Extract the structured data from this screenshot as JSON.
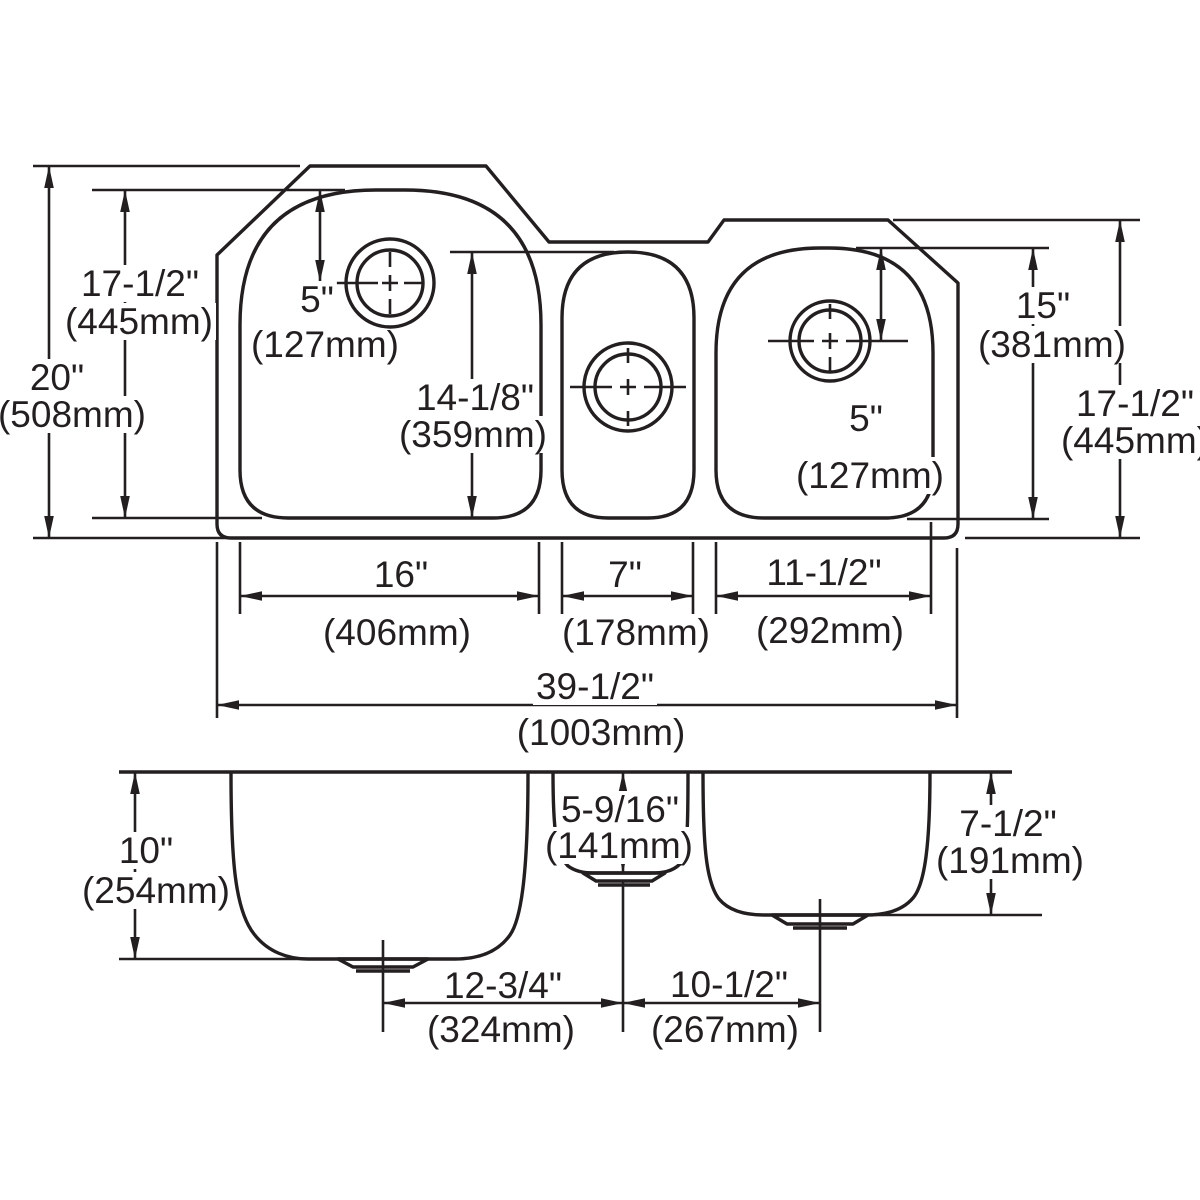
{
  "colors": {
    "line": "#231f20",
    "background": "#ffffff"
  },
  "top_view": {
    "overall_height_in": "20\"",
    "overall_height_mm": "(508mm)",
    "left_bowl_height_in": "17-1/2\"",
    "left_bowl_height_mm": "(445mm)",
    "left_faucet_offset_in": "5\"",
    "left_faucet_offset_mm": "(127mm)",
    "middle_bowl_length_in": "14-1/8\"",
    "middle_bowl_length_mm": "(359mm)",
    "right_bowl_length_in": "15\"",
    "right_bowl_length_mm": "(381mm)",
    "right_rim_height_in": "17-1/2\"",
    "right_rim_height_mm": "(445mm)",
    "right_faucet_offset_in": "5\"",
    "right_faucet_offset_mm": "(127mm)",
    "left_bowl_width_in": "16\"",
    "left_bowl_width_mm": "(406mm)",
    "middle_bowl_width_in": "7\"",
    "middle_bowl_width_mm": "(178mm)",
    "right_bowl_width_in": "11-1/2\"",
    "right_bowl_width_mm": "(292mm)",
    "overall_width_in": "39-1/2\"",
    "overall_width_mm": "(1003mm)"
  },
  "side_view": {
    "left_bowl_depth_in": "10\"",
    "left_bowl_depth_mm": "(254mm)",
    "middle_bowl_depth_in": "5-9/16\"",
    "middle_bowl_depth_mm": "(141mm)",
    "right_bowl_depth_in": "7-1/2\"",
    "right_bowl_depth_mm": "(191mm)",
    "left_drain_offset_in": "12-3/4\"",
    "left_drain_offset_mm": "(324mm)",
    "right_drain_offset_in": "10-1/2\"",
    "right_drain_offset_mm": "(267mm)"
  }
}
